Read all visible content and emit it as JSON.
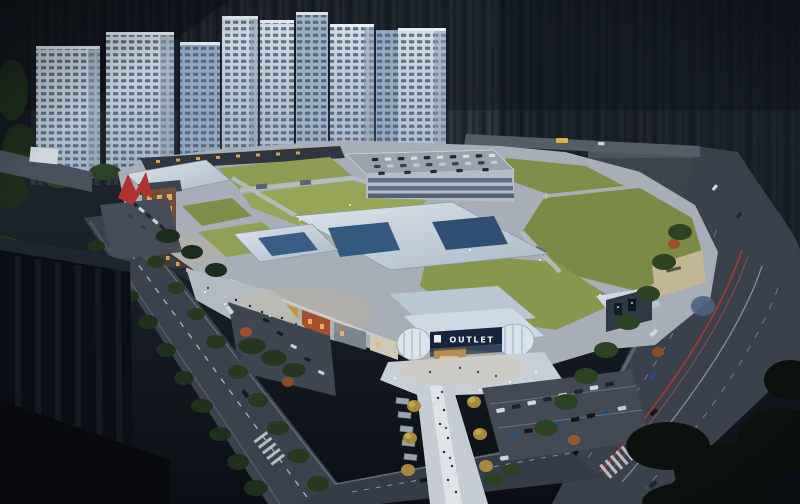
{
  "scene": {
    "description": "Dusk aerial architectural rendering of an outlet shopping mall with green roofs, fronted by roads and parking, backed by a row of lit residential high-rise towers against a dark city skyline",
    "signage": {
      "outlet_sign": "OUTLET"
    },
    "counts": {
      "residential_towers": 9
    },
    "colors": {
      "sky_city_dark": "#161b22",
      "tower_facade": "#c2cfdb",
      "tower_glass": "#44586d",
      "grass_roof": "#8a9a4f",
      "white_canopy": "#ccd7e1",
      "skylight_glass": "#32557e",
      "road_asphalt": "#3a414d",
      "taillight_red": "#b0392f",
      "facade_orange": "#b96a2c",
      "facade_amber": "#c8912f",
      "sign_band_navy": "#16233d",
      "tree_dark_green": "#1f301d",
      "sculpture_red": "#b23230",
      "plaza_light": "#c8ced6"
    }
  }
}
